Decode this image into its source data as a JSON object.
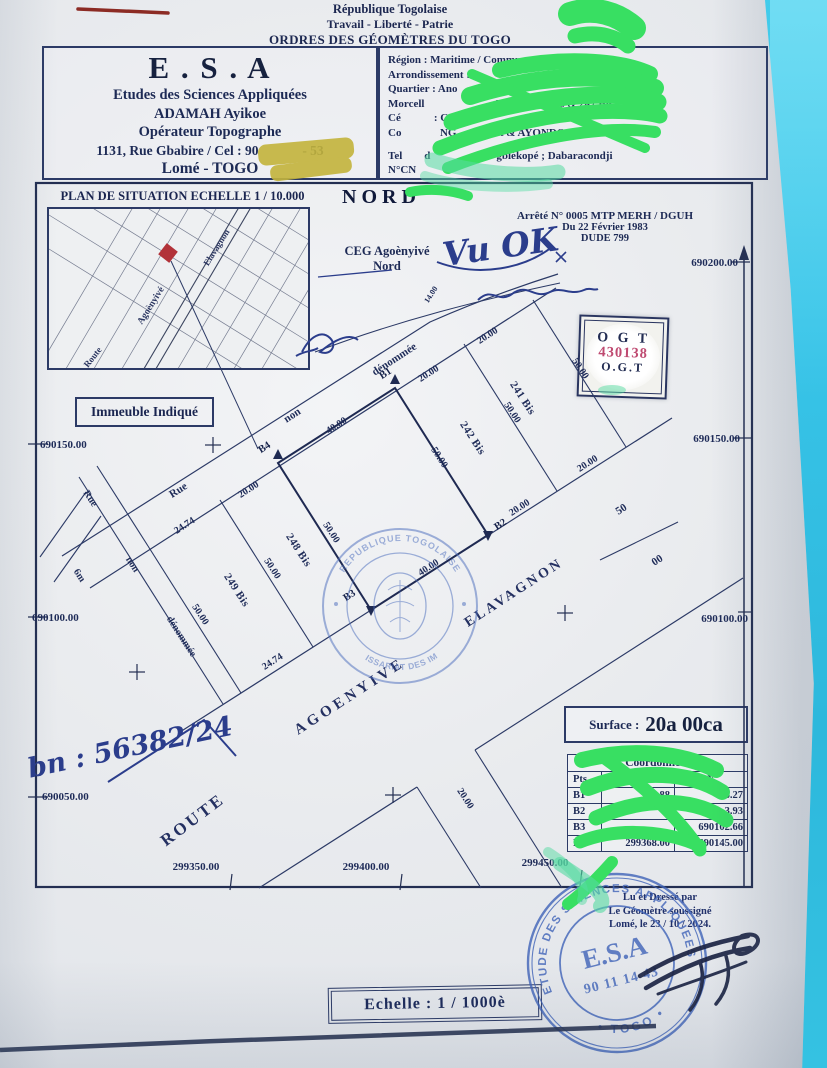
{
  "header": {
    "line1": "République Togolaise",
    "line2": "Travail - Liberté - Patrie",
    "line3": "ORDRES DES GÉOMÈTRES DU TOGO"
  },
  "firm_box": {
    "title": "E . S . A",
    "lines": [
      "Etudes des Sciences Appliquées",
      "ADAMAH Ayikoe",
      "Opérateur Topographe",
      "1131, Rue Gbabire / Cel : 90             - 53",
      "Lomé - TOGO"
    ]
  },
  "admin_box": {
    "lines": [
      "Région : Maritime / Commune Agoènyivé 1",
      "Arrondissement :                                yivé",
      "Quartier : Ano",
      "Morcell                          Lots n°           s & 247 Bis",
      "Cé            : C",
      "Co              NG              et & AYONDO Messanvi",
      "Tel        d                        gblékopé ; Dabaracondji",
      "N°CN"
    ]
  },
  "situation": {
    "title": "PLAN DE SITUATION ECHELLE 1 / 10.000",
    "streets": [
      "Elavagnon",
      "Agoènyivé",
      "Route"
    ],
    "indicator": "Immeuble Indiqué"
  },
  "north_label": "NORD",
  "arrete": {
    "line1": "Arrêté N° 0005 MTP MERH / DGUH",
    "line2": "Du 22 Février 1983",
    "line3": "DUDE 799"
  },
  "ceg": {
    "line1": "CEG Agoènyivé",
    "line2": "Nord"
  },
  "ogt_sticker": {
    "line1": "O G T",
    "number": "430138",
    "line2": "O.G.T"
  },
  "handwriting": {
    "approval": "Vu OK",
    "file_number": "bn : 56382/24"
  },
  "grid": {
    "right": [
      "690200.00",
      "690150.00",
      "690100.00"
    ],
    "left": [
      "690150.00",
      "690100.00",
      "690050.00"
    ],
    "bottom": [
      "299350.00",
      "299400.00",
      "299450.00"
    ]
  },
  "plan": {
    "points": {
      "b1": "B1",
      "b2": "B2",
      "b3": "B3",
      "b4": "B4"
    },
    "parcels": {
      "p241": "241 Bis",
      "p242": "242 Bis",
      "p248": "248 Bis",
      "p249": "249 Bis"
    },
    "top_road": {
      "w1": "Rue",
      "w2": "non",
      "w3": "dénommée"
    },
    "left_street": {
      "w1": "Rue",
      "w2": "non",
      "w3": "dénommée",
      "width": "6m"
    },
    "route": {
      "w1": "ROUTE",
      "w2": "AGOENYIVE",
      "w3": "ELAVAGNON"
    },
    "road_width": {
      "a": "50",
      "b": "00"
    },
    "dims": {
      "front_total": "40.00",
      "front_248": "20.00",
      "front_249": "24.74",
      "front_242": "20.00",
      "front_241": "20.00",
      "side_b1b2": "50.00",
      "side_b4b3": "50.00",
      "side_249": "50.00",
      "side_248": "50.00",
      "side_242": "50.00",
      "side_241": "50.00",
      "back_249": "24.74",
      "back_plot": "40.00",
      "back_242": "20.00",
      "back_241": "20.00",
      "side_street": "20.00",
      "small": "14.00"
    }
  },
  "surface": {
    "label": "Surface :",
    "value": "20a 00ca"
  },
  "coords_table": {
    "title": "Coordonnées",
    "col_pts": "Pts",
    "col_x": "X",
    "col_y": "Y",
    "rows": [
      {
        "pt": "B1",
        "x": "88",
        "y": "6.27"
      },
      {
        "pt": "B2",
        "x": "",
        "y": "3.93"
      },
      {
        "pt": "B3",
        "x": "",
        "y": "690102.66"
      },
      {
        "pt": "B4",
        "x": "299368.00",
        "y": "690145.00"
      }
    ]
  },
  "certification": {
    "line1": "Lu et Dressé par",
    "line2": "Le Géomètre soussigné",
    "line3": "Lomé, le 23 / 10 / 2024."
  },
  "scale_box": "Echelle : 1 / 1000è",
  "stamps": {
    "impots": {
      "arc_top": "REPUBLIQUE TOGOLAISE",
      "arc_bottom": "COMMISSARIAT DES IMPOTS"
    },
    "esa": {
      "arc_top": "ETUDE DES SCIENCES APPLIQUEES",
      "arc_bottom": "• TOGO •",
      "name": "E.S.A",
      "phone": "90 11 14 43"
    }
  },
  "colors": {
    "print_navy": "#1e2b58",
    "desk_cyan": "#38c4e8",
    "marker_green": "#38df62",
    "marker_teal": "#55dba1",
    "marker_yellow": "#c3b43c",
    "stamp_blue": "#4e6fbe",
    "ogt_number_red": "#bf4a71"
  }
}
